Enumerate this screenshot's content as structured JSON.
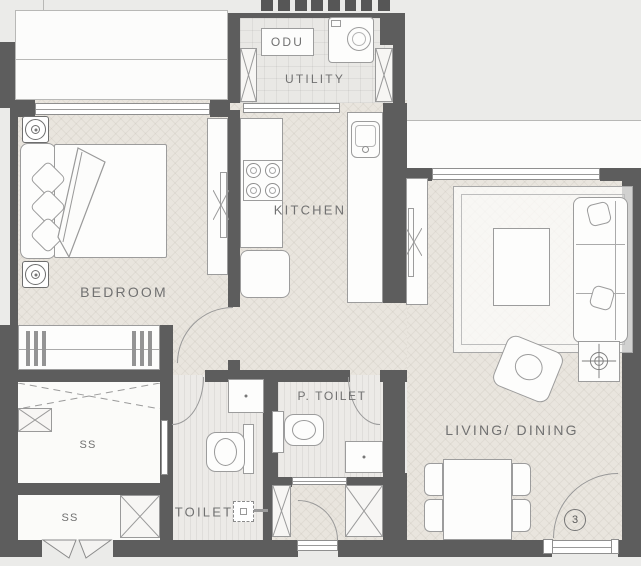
{
  "plan_labels": {
    "odu": "ODU",
    "utility": "UTILITY",
    "kitchen": "KITCHEN",
    "bedroom": "BEDROOM",
    "living_dining": "LIVING/ DINING",
    "p_toilet": "P. TOILET",
    "toilet": "TOILET",
    "ss_upper": "SS",
    "ss_lower": "SS",
    "entry_door_number": "3"
  },
  "colors": {
    "background": "#ebebe9",
    "wall": "#5d5d5d",
    "floor_wood": "#e9e5de",
    "floor_tile": "#e9e8e5",
    "floor_stripe": "#eceae7",
    "drawing_line": "#999999",
    "label_text": "#717171"
  }
}
